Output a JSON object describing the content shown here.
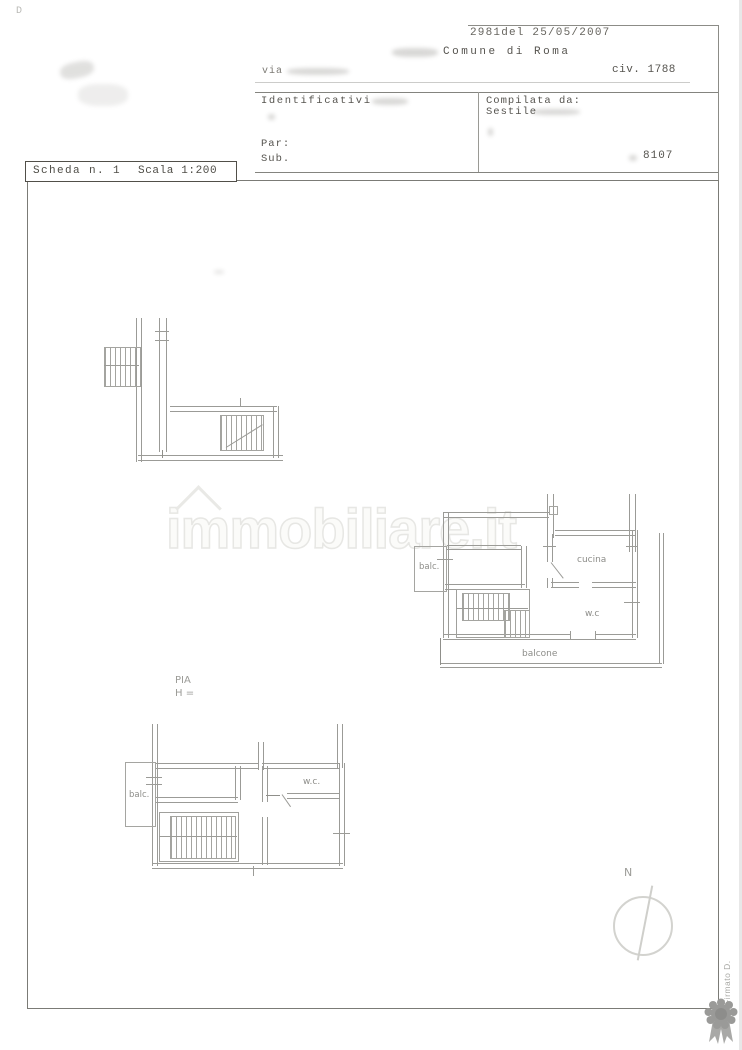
{
  "colors": {
    "paper": "#ffffff",
    "ink": "#56544f",
    "line": "#9b9b97",
    "watermark": "#e7e7e4",
    "badge_gray": "#9a9a98"
  },
  "header": {
    "corner_mark": "D",
    "stamp_number": "2981del 25/05/2007",
    "municipality": "Comune di Roma",
    "street_prefix": "via",
    "civic": "civ. 1788",
    "identifiers_label": "Identificativi",
    "compiled_by_label": "Compilata da:",
    "compiled_by_name": "Sestile",
    "parcel_label": "Par:",
    "sub_label": "Sub.",
    "doc_number": "8107"
  },
  "sheet_box": {
    "sheet": "Scheda n. 1",
    "scale": "Scala 1:200"
  },
  "watermark": {
    "text": "immobiliare.it"
  },
  "plan_mid": {
    "balcony_left": "balc.",
    "kitchen": "cucina",
    "wc": "w.c",
    "balcony_bottom": "balcone"
  },
  "plan_bottom": {
    "caption_line1": "PIA",
    "caption_line2": "H =",
    "balcony_left": "balc.",
    "wc": "w.c."
  },
  "compass": {
    "north": "N"
  },
  "side_note": {
    "text": "Firmato D."
  }
}
